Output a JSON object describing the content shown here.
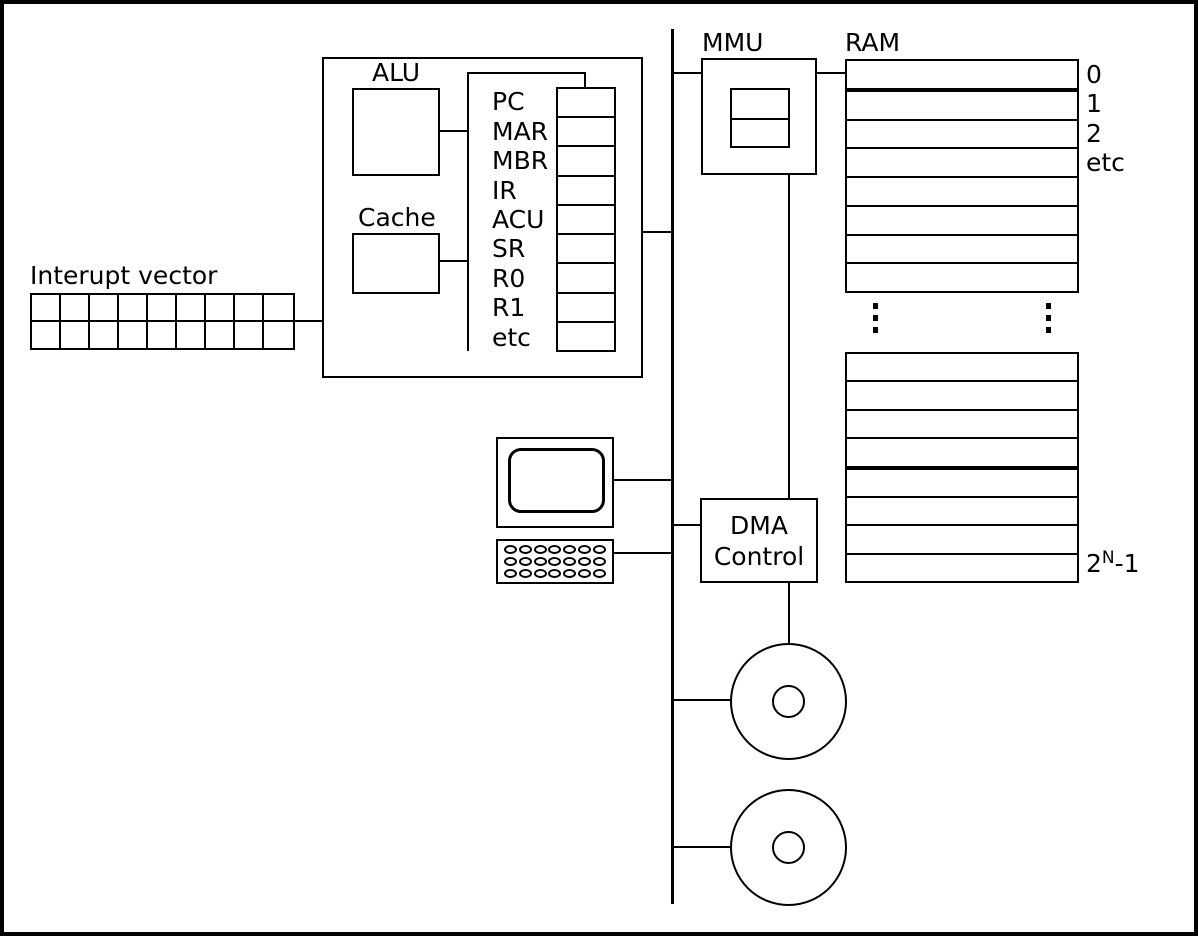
{
  "cpu": {
    "alu_label": "ALU",
    "cache_label": "Cache",
    "registers": [
      "PC",
      "MAR",
      "MBR",
      "IR",
      "ACU",
      "SR",
      "R0",
      "R1",
      "etc"
    ]
  },
  "interrupt_vector": {
    "label": "Interupt vector"
  },
  "mmu": {
    "label": "MMU"
  },
  "ram": {
    "label": "RAM",
    "address_labels": [
      "0",
      "1",
      "2",
      "etc"
    ],
    "last_address": {
      "base": "2",
      "sup": "N",
      "tail": "-1"
    }
  },
  "dma": {
    "label_line1": "DMA",
    "label_line2": "Control"
  },
  "colors": {
    "line": "#000000",
    "background": "#ffffff"
  }
}
